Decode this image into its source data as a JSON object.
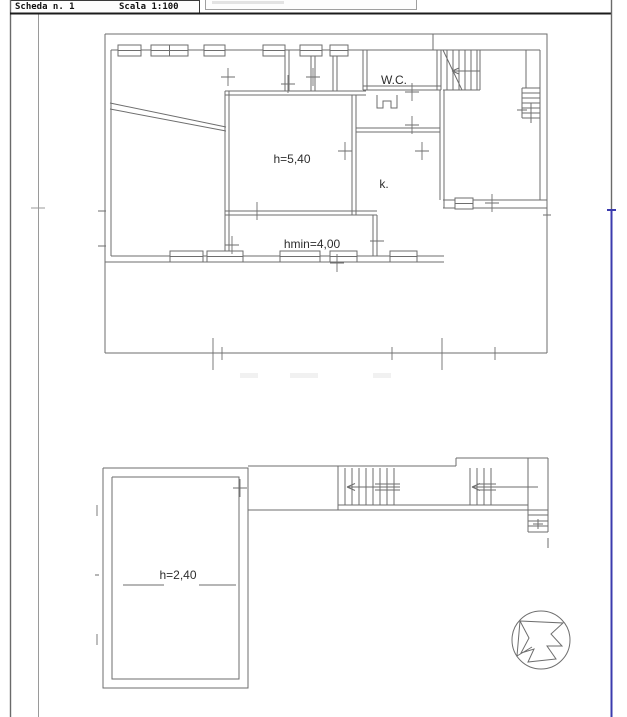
{
  "header": {
    "sheet_label": "Scheda n. 1",
    "scale_label": "Scala 1:100"
  },
  "plans": {
    "upper": {
      "labels": {
        "wc": "W.C.",
        "main_room_height": "h=5,40",
        "kitchen": "k.",
        "min_height": "hmin=4,00"
      }
    },
    "lower": {
      "labels": {
        "room_height": "h=2,40"
      }
    }
  },
  "icons": {
    "compass": "north-arrow-icon"
  },
  "colors": {
    "plan_line": "#6e6e6e",
    "frame_dark": "#1b1b1b",
    "frame_blue": "#3b3bae",
    "background": "#ffffff"
  }
}
